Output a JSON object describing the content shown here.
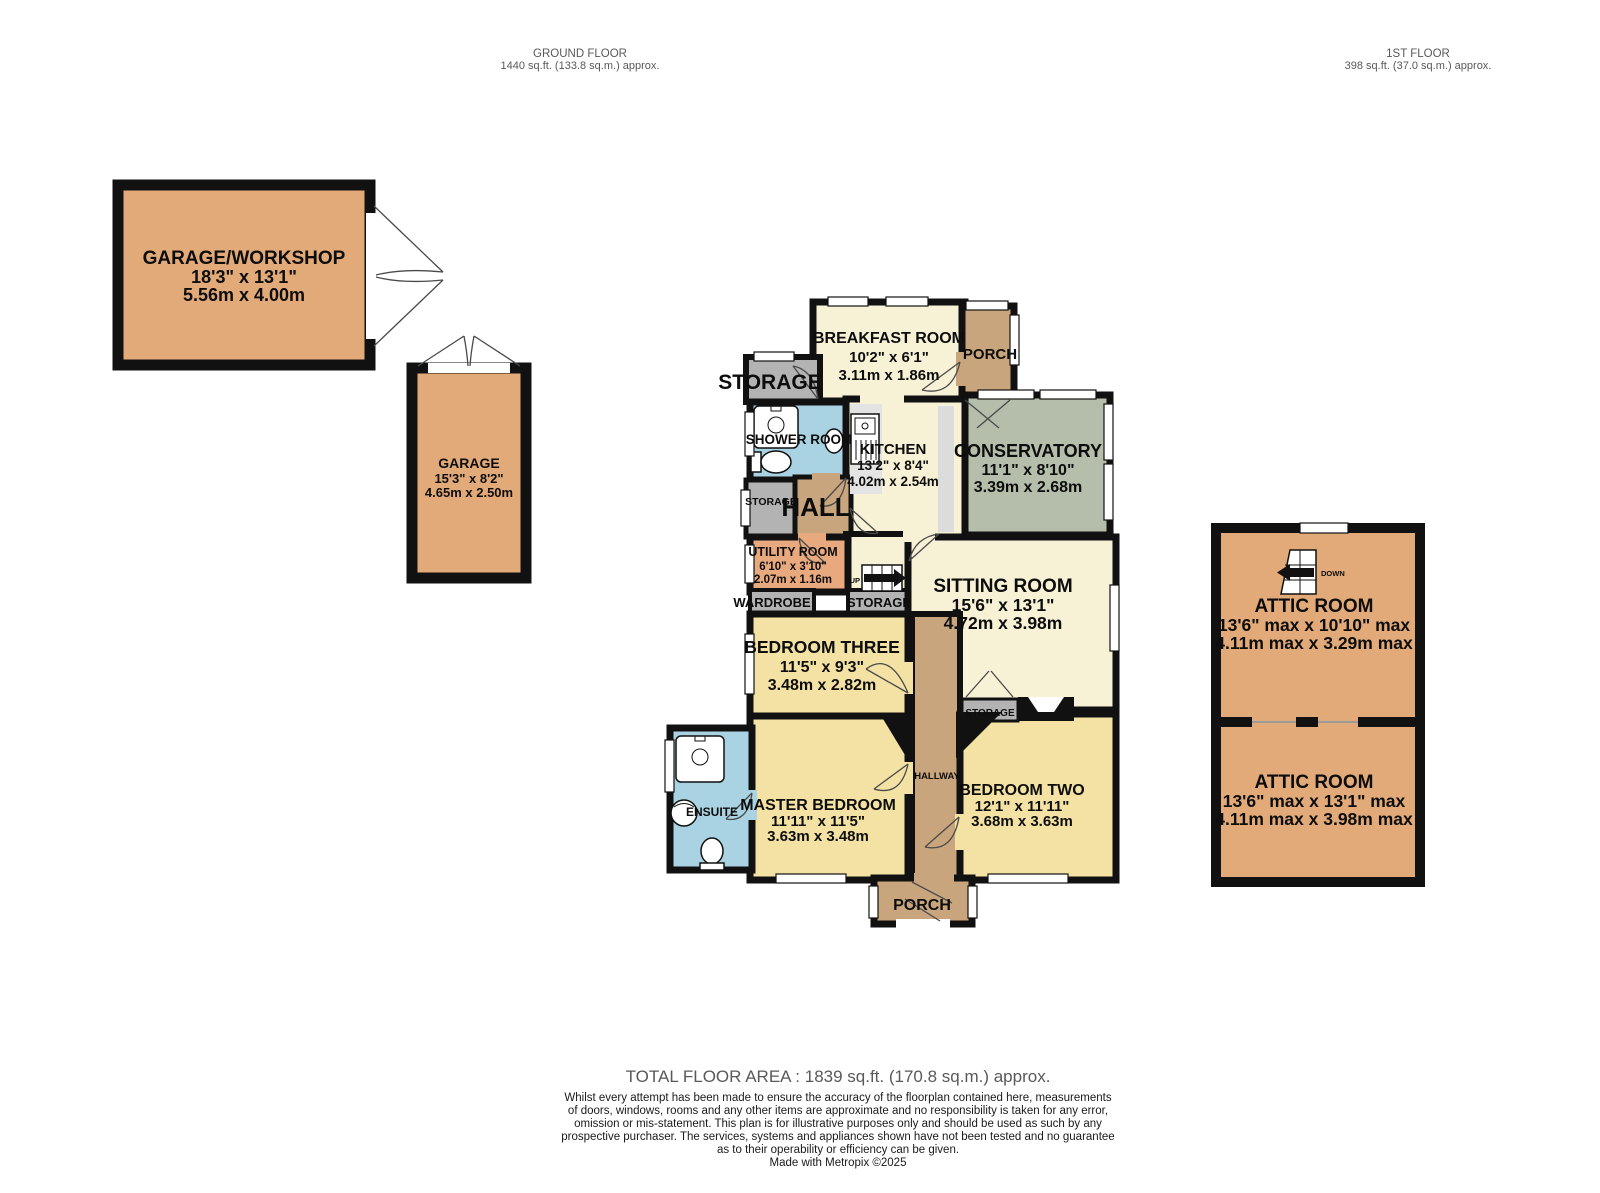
{
  "header": {
    "ground_floor": {
      "title": "GROUND FLOOR",
      "area": "1440 sq.ft. (133.8 sq.m.) approx."
    },
    "first_floor": {
      "title": "1ST FLOOR",
      "area": "398 sq.ft. (37.0 sq.m.) approx."
    }
  },
  "rooms": {
    "garage_workshop": {
      "name": "GARAGE/WORKSHOP",
      "imperial": "18'3\" x 13'1\"",
      "metric": "5.56m x 4.00m"
    },
    "garage": {
      "name": "GARAGE",
      "imperial": "15'3\" x 8'2\"",
      "metric": "4.65m x 2.50m"
    },
    "breakfast_room": {
      "name": "BREAKFAST ROOM",
      "imperial": "10'2\" x 6'1\"",
      "metric": "3.11m x 1.86m"
    },
    "kitchen": {
      "name": "KITCHEN",
      "imperial": "13'2\" x 8'4\"",
      "metric": "4.02m x 2.54m"
    },
    "conservatory": {
      "name": "CONSERVATORY",
      "imperial": "11'1\" x 8'10\"",
      "metric": "3.39m x 2.68m"
    },
    "utility_room": {
      "name": "UTILITY ROOM",
      "imperial": "6'10\" x 3'10\"",
      "metric": "2.07m x 1.16m"
    },
    "sitting_room": {
      "name": "SITTING ROOM",
      "imperial": "15'6\" x 13'1\"",
      "metric": "4.72m x 3.98m"
    },
    "bedroom_three": {
      "name": "BEDROOM THREE",
      "imperial": "11'5\" x 9'3\"",
      "metric": "3.48m x 2.82m"
    },
    "master_bedroom": {
      "name": "MASTER BEDROOM",
      "imperial": "11'11\" x 11'5\"",
      "metric": "3.63m x 3.48m"
    },
    "bedroom_two": {
      "name": "BEDROOM TWO",
      "imperial": "12'1\" x 11'11\"",
      "metric": "3.68m x 3.63m"
    },
    "attic_room_one": {
      "name": "ATTIC ROOM",
      "imperial": "13'6\" max x 10'10\" max",
      "metric": "4.11m max x 3.29m max"
    },
    "attic_room_two": {
      "name": "ATTIC ROOM",
      "imperial": "13'6\" max x 13'1\" max",
      "metric": "4.11m max x 3.98m max"
    },
    "shower_room": {
      "name": "SHOWER ROOM"
    },
    "hall": {
      "name": "HALL"
    },
    "hallway": {
      "name": "HALLWAY"
    },
    "ensuite": {
      "name": "ENSUITE"
    },
    "porch_top": {
      "name": "PORCH"
    },
    "porch_bottom": {
      "name": "PORCH"
    }
  },
  "labels": {
    "storage": "STORAGE",
    "wardrobe": "WARDROBE",
    "up": "UP",
    "down": "DOWN"
  },
  "footer": {
    "total": "TOTAL FLOOR AREA : 1839 sq.ft. (170.8 sq.m.) approx.",
    "disclaimer_lines": [
      "Whilst every attempt has been made to ensure the accuracy of the floorplan contained here, measurements",
      "of doors, windows, rooms and any other items are approximate and no responsibility is taken for any error,",
      "omission or mis-statement. This plan is for illustrative purposes only and should be used as such by any",
      "prospective purchaser. The services, systems and appliances shown have not been tested and no guarantee",
      "as to their operability or efficiency can be given."
    ],
    "credit": "Made with Metropix ©2025"
  },
  "colors": {
    "room_tan": "#e2aa79",
    "porch_tan": "#c8a57c",
    "cream": "#f7f1d6",
    "bedroom_yellow": "#f3e2a4",
    "bath_blue": "#a9d3e2",
    "conservatory_sage": "#b5bdab",
    "storage_gray": "#b3b3b3",
    "utility_salmon": "#e9a97e",
    "wall": "#111111"
  }
}
